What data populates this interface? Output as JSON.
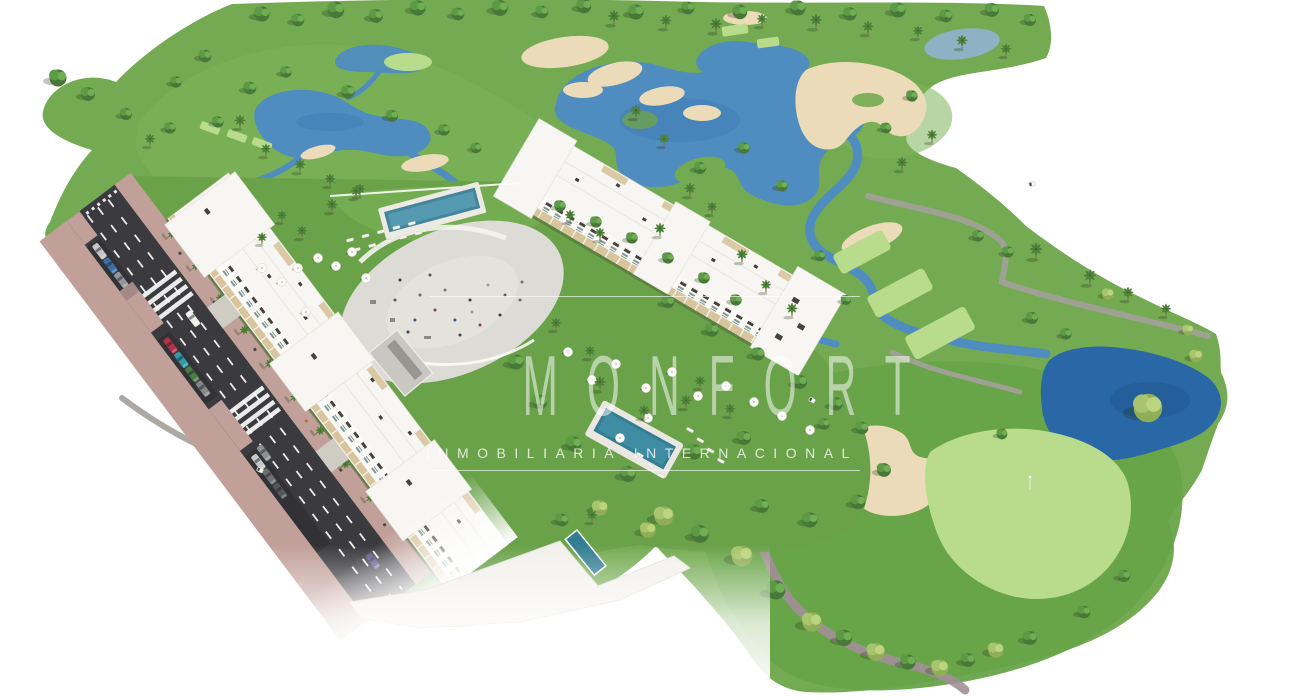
{
  "watermark": {
    "brand": "MONFORT",
    "tagline": "INMOBILIARIA INTERNACIONAL"
  },
  "palette": {
    "land": "#74ab52",
    "fairway_light": "#b9dc8c",
    "water": "#4f8cc0",
    "water_dark": "#2a67a6",
    "sand": "#ecdbb8",
    "road_asphalt": "#3b3b3f",
    "sidewalk_pink": "#c2a09a",
    "building_white": "#f7f6f2",
    "pool_teal": "#337e92",
    "plaza_gray": "#dcdbd5",
    "path_gray": "#a3a09b",
    "path_mauve": "#a28f98",
    "tree_dark": "#477838",
    "tree_mid": "#5c9a45",
    "tree_highlight": "#6fae52",
    "olive_dark": "#8fae57",
    "olive_mid": "#a8c46c",
    "olive_light": "#bdd47f",
    "palm_green": "#4d8038"
  }
}
